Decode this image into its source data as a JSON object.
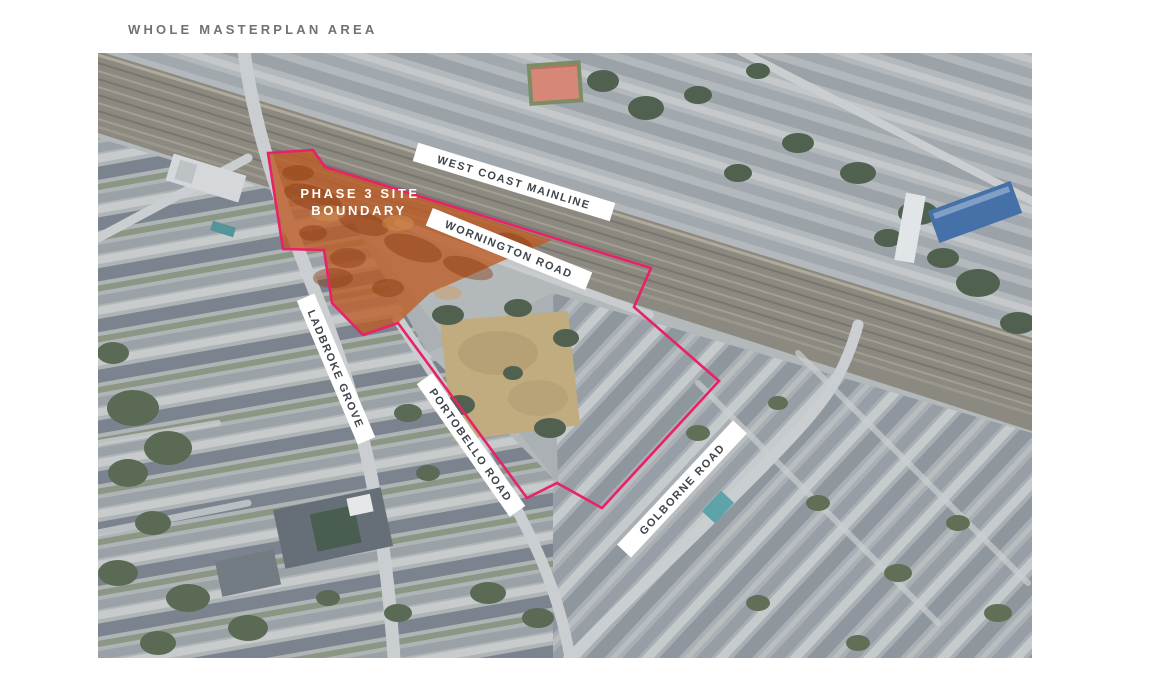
{
  "page": {
    "title": "WHOLE MASTERPLAN AREA"
  },
  "map": {
    "type": "satellite-aerial",
    "boundary_color": "#e82168",
    "phase3_fill_color": "#bf5b24",
    "masterplan_boundary_points": "170,100 215,97 227,114 553,215 536,254 621,328 504,455 459,430 429,445 300,270 265,282 234,250 226,197 185,196",
    "phase3_area_points": "170,100 215,97 227,114 454,187 402,209 332,240 300,270 265,282 234,250 226,197 185,196",
    "phase3_label_line1": "PHASE 3 SITE",
    "phase3_label_line2": "BOUNDARY",
    "road_labels": [
      {
        "text": "WEST COAST MAINLINE",
        "x": 416,
        "y": 129,
        "angle": 17,
        "width": 206
      },
      {
        "text": "WORNINGTON ROAD",
        "x": 411,
        "y": 196,
        "angle": 22,
        "width": 172
      },
      {
        "text": "LADBROKE GROVE",
        "x": 238,
        "y": 316,
        "angle": 67,
        "width": 156
      },
      {
        "text": "PORTOBELLO ROAD",
        "x": 373,
        "y": 392,
        "angle": 55,
        "width": 162
      },
      {
        "text": "GOLBORNE ROAD",
        "x": 584,
        "y": 436,
        "angle": -47,
        "width": 170
      }
    ]
  }
}
